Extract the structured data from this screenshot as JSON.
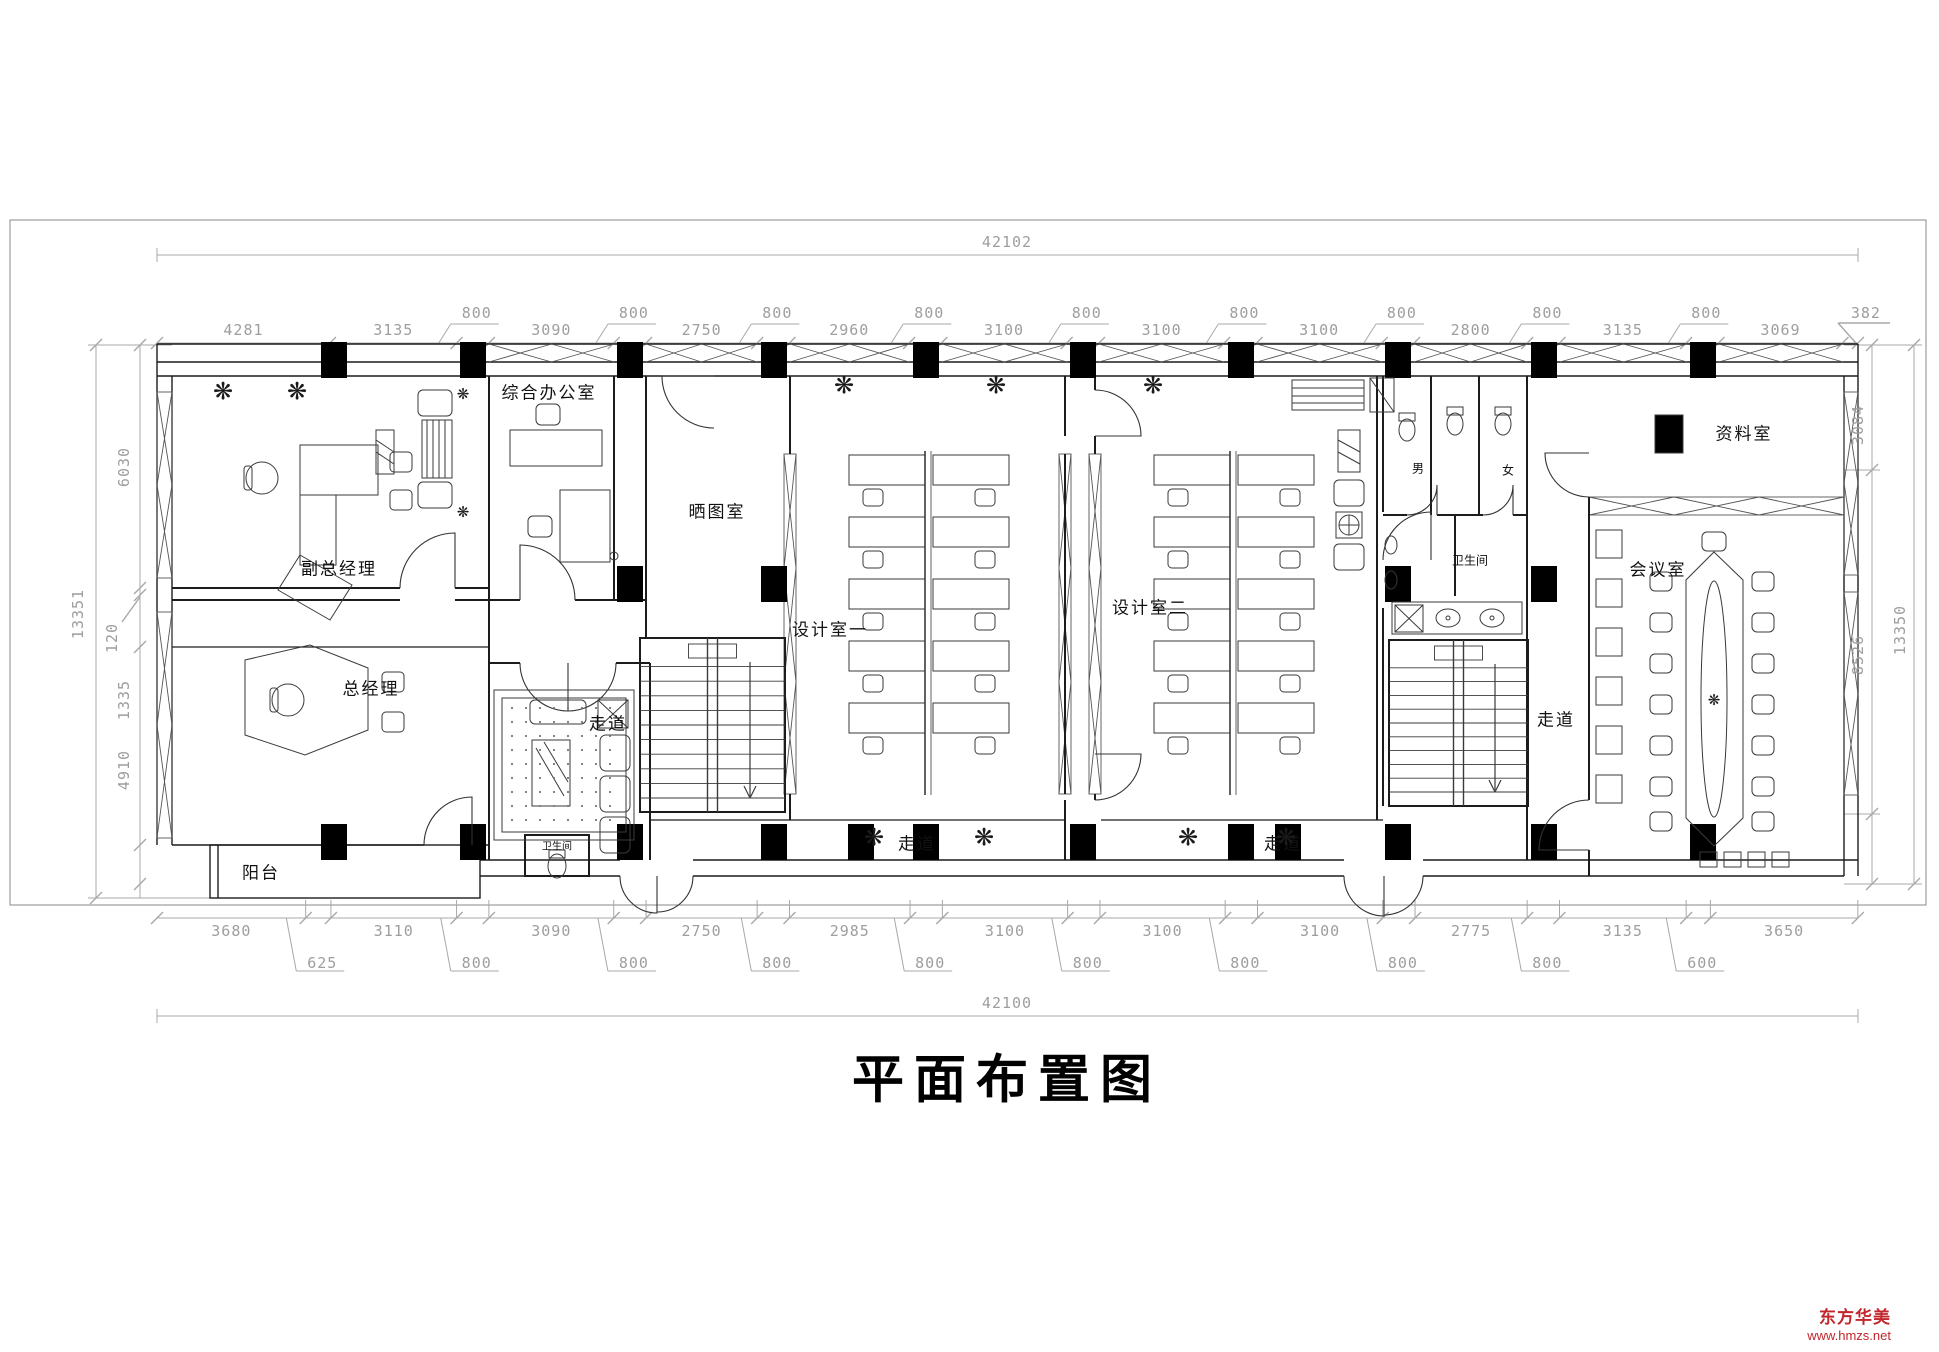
{
  "title": "平面布置图",
  "watermark": {
    "name": "东方华美",
    "url": "www.hmzs.net"
  },
  "icons": {
    "plant": "❋"
  },
  "dimensions": {
    "top": {
      "total": "42102",
      "items": [
        [
          "m",
          "4281"
        ],
        [
          "m",
          "3135"
        ],
        [
          "s",
          "800"
        ],
        [
          "m",
          "3090"
        ],
        [
          "s",
          "800"
        ],
        [
          "m",
          "2750"
        ],
        [
          "s",
          "800"
        ],
        [
          "m",
          "2960"
        ],
        [
          "s",
          "800"
        ],
        [
          "m",
          "3100"
        ],
        [
          "s",
          "800"
        ],
        [
          "m",
          "3100"
        ],
        [
          "s",
          "800"
        ],
        [
          "m",
          "3100"
        ],
        [
          "s",
          "800"
        ],
        [
          "m",
          "2800"
        ],
        [
          "s",
          "800"
        ],
        [
          "m",
          "3135"
        ],
        [
          "s",
          "800"
        ],
        [
          "m",
          "3069"
        ],
        [
          "e",
          "382"
        ]
      ]
    },
    "bottom": {
      "total": "42100",
      "items": [
        [
          "m",
          "3680"
        ],
        [
          "s",
          "625"
        ],
        [
          "m",
          "3110"
        ],
        [
          "s",
          "800"
        ],
        [
          "m",
          "3090"
        ],
        [
          "s",
          "800"
        ],
        [
          "m",
          "2750"
        ],
        [
          "s",
          "800"
        ],
        [
          "m",
          "2985"
        ],
        [
          "s",
          "800"
        ],
        [
          "m",
          "3100"
        ],
        [
          "s",
          "800"
        ],
        [
          "m",
          "3100"
        ],
        [
          "s",
          "800"
        ],
        [
          "m",
          "3100"
        ],
        [
          "s",
          "800"
        ],
        [
          "m",
          "2775"
        ],
        [
          "s",
          "800"
        ],
        [
          "m",
          "3135"
        ],
        [
          "s",
          "600"
        ],
        [
          "m",
          "3650"
        ]
      ]
    },
    "left": {
      "outer": "13351",
      "inner": [
        "6030",
        "120",
        "1335",
        "4910"
      ]
    },
    "right": {
      "outer": "13350",
      "inner": [
        "3084",
        "8526"
      ]
    }
  },
  "rooms": {
    "deputy_gm": "副总经理",
    "gm": "总经理",
    "balcony": "阳台",
    "general_office": "综合办公室",
    "blueprint": "晒图室",
    "design1": "设计室一",
    "design2": "设计室二",
    "corridor_left": "走道",
    "corridor_bottom1": "走道",
    "corridor_bottom2": "走道",
    "corridor_right": "走道",
    "toilet": "卫生间",
    "toilet_small": "卫生间",
    "male": "男",
    "female": "女",
    "archive": "资料室",
    "meeting": "会议室"
  }
}
